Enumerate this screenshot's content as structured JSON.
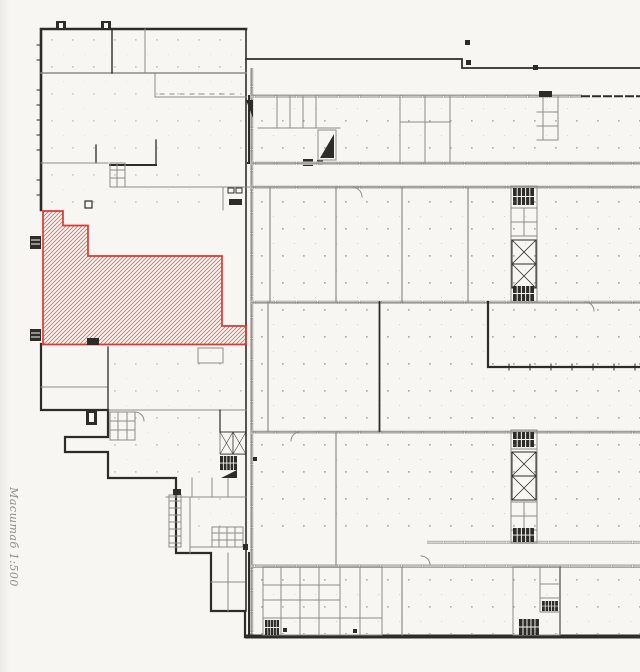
{
  "plan": {
    "scale_label": "Масштаб 1:500"
  },
  "highlight_area": {
    "points": "43,211 63,211 63,225.5 88,225.5 88,256 222,256 222,326 246,326 246,344.5 43,344.5"
  },
  "colors": {
    "paper": "#f7f6f2",
    "paper_edge": "#e7e4df",
    "wall_dark": "#2e2c29",
    "wall_mid": "#8f8c87",
    "wall_light": "#cac7c2",
    "dot": "#74716c",
    "highlight": "#d93a32",
    "hatch": "#b17f78",
    "text_grey": "#908d89"
  }
}
